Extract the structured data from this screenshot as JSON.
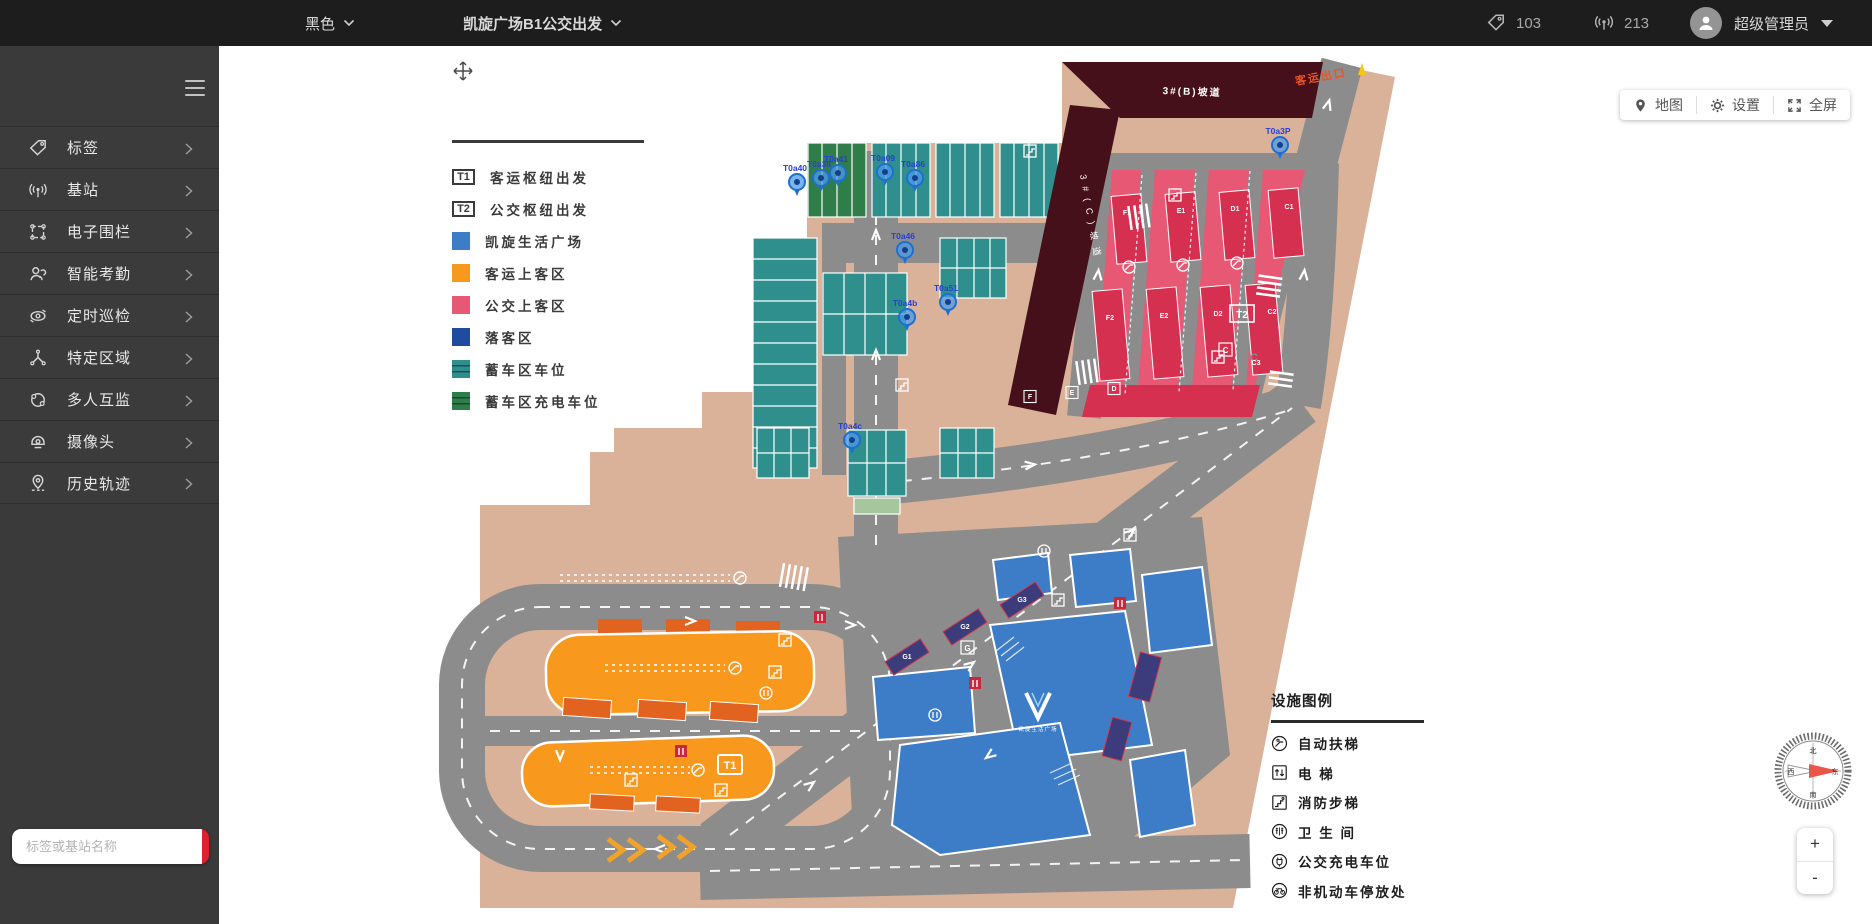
{
  "topbar": {
    "theme_label": "黑色",
    "map_title": "凯旋广场B1公交出发",
    "tag_count": "103",
    "station_count": "213",
    "user_name": "超级管理员"
  },
  "sidebar": {
    "menu": [
      {
        "icon": "tag-icon",
        "label": "标签"
      },
      {
        "icon": "station-icon",
        "label": "基站"
      },
      {
        "icon": "fence-icon",
        "label": "电子围栏"
      },
      {
        "icon": "attendance-icon",
        "label": "智能考勤"
      },
      {
        "icon": "patrol-icon",
        "label": "定时巡检"
      },
      {
        "icon": "area-icon",
        "label": "特定区域"
      },
      {
        "icon": "mutual-icon",
        "label": "多人互监"
      },
      {
        "icon": "camera-icon",
        "label": "摄像头"
      },
      {
        "icon": "history-icon",
        "label": "历史轨迹"
      }
    ],
    "search_placeholder": "标签或基站名称"
  },
  "map_toolbar": {
    "map_label": "地图",
    "settings_label": "设置",
    "fullscreen_label": "全屏"
  },
  "map_legend": [
    {
      "type": "box",
      "key": "T1",
      "label": "客运枢纽出发"
    },
    {
      "type": "box",
      "key": "T2",
      "label": "公交枢纽出发"
    },
    {
      "type": "swatch",
      "color": "#3d7dc8",
      "label": "凯旋生活广场"
    },
    {
      "type": "swatch",
      "color": "#f8991d",
      "label": "客运上客区"
    },
    {
      "type": "swatch",
      "color": "#e65874",
      "label": "公交上客区"
    },
    {
      "type": "swatch",
      "color": "#1f4ba0",
      "label": "落客区"
    },
    {
      "type": "swatch-lines",
      "color": "#2f8f8c",
      "label": "蓄车区车位"
    },
    {
      "type": "swatch-lines",
      "color": "#2f7d49",
      "label": "蓄车区充电车位"
    }
  ],
  "facility_legend": {
    "title": "设施图例",
    "items": [
      {
        "icon": "escalator-icon",
        "label": "自动扶梯"
      },
      {
        "icon": "elevator-icon",
        "label": "电 梯"
      },
      {
        "icon": "fire-stairs-icon",
        "label": "消防步梯"
      },
      {
        "icon": "toilet-icon",
        "label": "卫 生 间"
      },
      {
        "icon": "bus-charging-icon",
        "label": "公交充电车位"
      },
      {
        "icon": "bicycle-parking-icon",
        "label": "非机动车停放处"
      }
    ]
  },
  "map": {
    "ramp_b_label": "3#(B)坡道",
    "ramp_c_label": "3#(C)坡道",
    "exit_label": "客运出口",
    "t1_label": "T1",
    "t2_label": "T2",
    "g_label": "G",
    "c_label": "C",
    "plaza_caption": "凯旋生活广场",
    "tag_pins": [
      {
        "id": "T0a40",
        "x": 367,
        "y": 127
      },
      {
        "id": "T0a38",
        "x": 391,
        "y": 123
      },
      {
        "id": "T0a41",
        "x": 408,
        "y": 118
      },
      {
        "id": "T0a09",
        "x": 455,
        "y": 117
      },
      {
        "id": "T0a86",
        "x": 485,
        "y": 123
      },
      {
        "id": "T0a46",
        "x": 475,
        "y": 195
      },
      {
        "id": "T0a51",
        "x": 518,
        "y": 247
      },
      {
        "id": "T0a4b",
        "x": 477,
        "y": 262
      },
      {
        "id": "T0a4c",
        "x": 422,
        "y": 385
      },
      {
        "id": "T0a3P",
        "x": 850,
        "y": 90
      }
    ],
    "bay_labels": [
      {
        "t": "F1",
        "x": 697,
        "y": 160
      },
      {
        "t": "E1",
        "x": 751,
        "y": 158
      },
      {
        "t": "D1",
        "x": 805,
        "y": 156
      },
      {
        "t": "C1",
        "x": 859,
        "y": 154
      },
      {
        "t": "F2",
        "x": 680,
        "y": 265
      },
      {
        "t": "E2",
        "x": 734,
        "y": 263
      },
      {
        "t": "D2",
        "x": 788,
        "y": 261
      },
      {
        "t": "C2",
        "x": 842,
        "y": 259
      },
      {
        "t": "C3",
        "x": 826,
        "y": 310
      },
      {
        "t": "F",
        "x": 600,
        "y": 344,
        "box": true
      },
      {
        "t": "E",
        "x": 642,
        "y": 340,
        "box": true
      },
      {
        "t": "D",
        "x": 684,
        "y": 336,
        "box": true
      }
    ],
    "drop_bay_labels": [
      {
        "t": "G1",
        "x": 477,
        "y": 604
      },
      {
        "t": "G2",
        "x": 535,
        "y": 574
      },
      {
        "t": "G3",
        "x": 592,
        "y": 547
      }
    ]
  },
  "zoom_control": {
    "zoom_in": "+",
    "zoom_out": "-"
  },
  "compass": {
    "north": "北",
    "south": "南",
    "east": "东",
    "west": "西"
  }
}
